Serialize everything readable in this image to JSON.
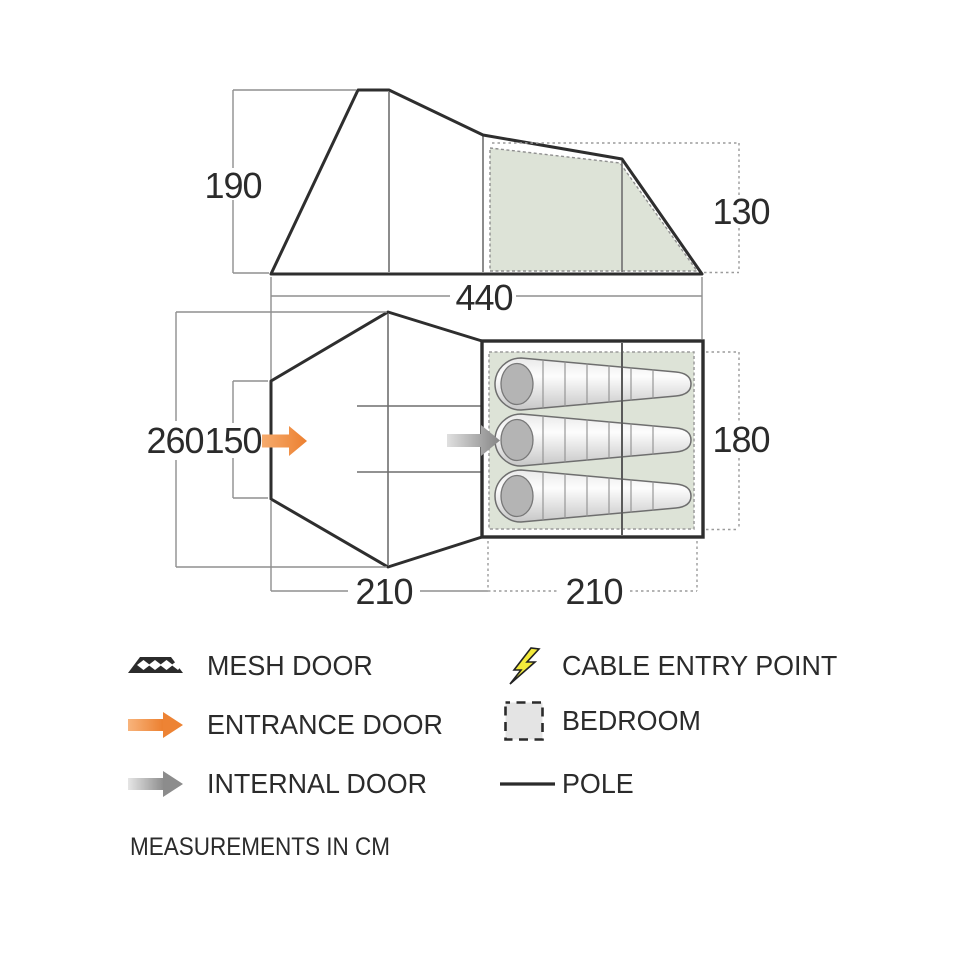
{
  "dimensions": {
    "side_view": {
      "left_height": "190",
      "right_height": "130",
      "total_length": "440"
    },
    "floor_plan": {
      "porch_width": "260",
      "entrance_width": "150",
      "bedroom_depth": "180",
      "porch_length": "210",
      "bedroom_length": "210"
    }
  },
  "legend": {
    "mesh_door": "MESH DOOR",
    "entrance_door": "ENTRANCE DOOR",
    "internal_door": "INTERNAL DOOR",
    "cable_entry_point": "CABLE ENTRY POINT",
    "bedroom": "BEDROOM",
    "pole": "POLE"
  },
  "note": "MEASUREMENTS IN CM",
  "colors": {
    "outline": "#2e2e2e",
    "dimension_line": "#8f8f8f",
    "bedroom_fill": "#dde3d7",
    "entrance_arrow_orange": "#ef8b3d",
    "internal_arrow_gray": "#8c8c8c",
    "cable_yellow": "#f3ea3b",
    "legend_square_fill": "#e4e4e4"
  }
}
